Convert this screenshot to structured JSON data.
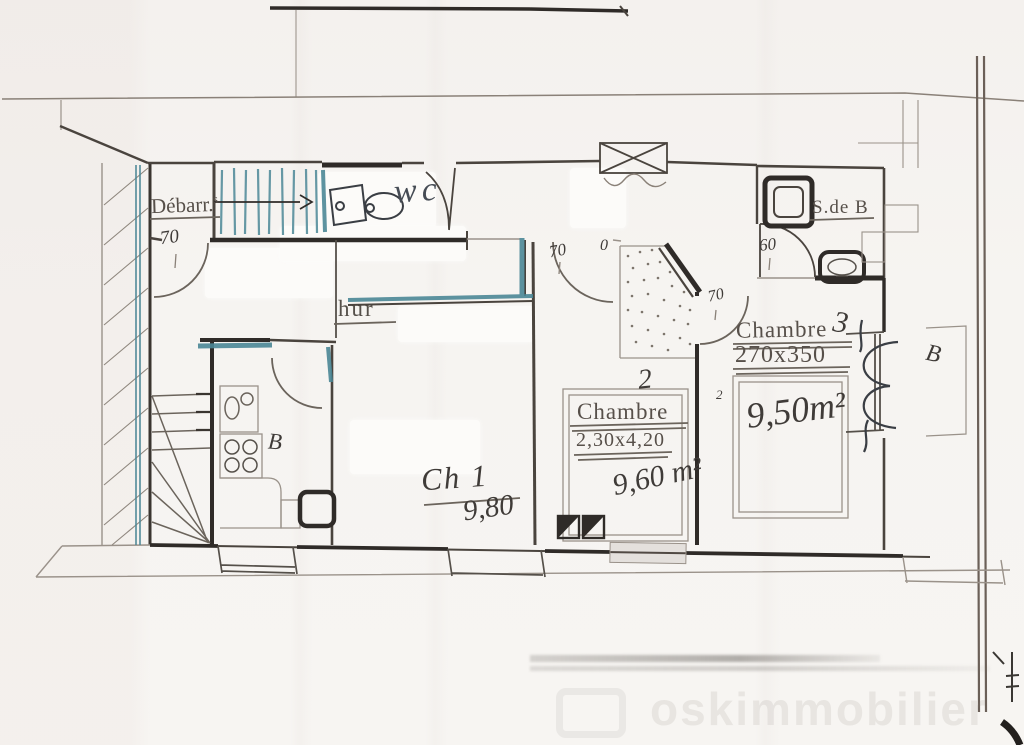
{
  "labels": {
    "debarras": "Débarr.",
    "debarras_sup": "s",
    "wc": "wc",
    "sdb": "S.de B",
    "chambre3_title": "Chambre",
    "chambre3_no": "3",
    "chambre3_dims": "270x350",
    "chambre3_area": "9,50m²",
    "chambre3_corner": "2",
    "chambre2_title": "Chambre",
    "chambre2_no": "2",
    "chambre2_dims": "2,30x4,20",
    "chambre2_area": "9,60 m²",
    "ch1_title": "Ch 1",
    "ch1_area": "9,80",
    "kitchen_note": "B",
    "right_note": "B",
    "erased_remnant": "hur"
  },
  "dimensions": {
    "d70": "70",
    "d60": "60",
    "zero": "0"
  },
  "watermark": {
    "text": "oskimmobilier"
  },
  "colors": {
    "pencil_dark": "#2f2b28",
    "pencil_mid": "#4a443e",
    "pencil_light": "#9a928a",
    "teal_pen": "#4b8796",
    "paper": "#f6f4f1"
  }
}
